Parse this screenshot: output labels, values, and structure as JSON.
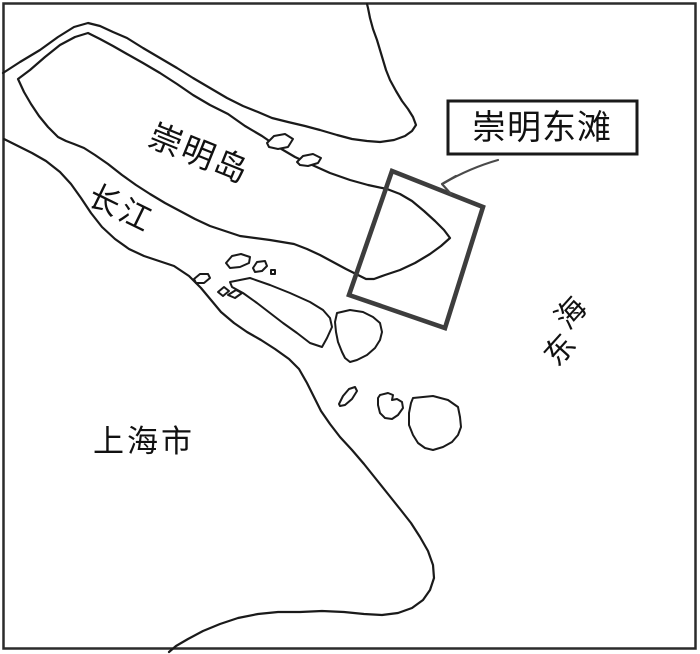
{
  "figure": {
    "background": "#ffffff",
    "border_color": "#2b2b2b",
    "line_color": "#1a1a1a",
    "highlight_color": "#3d3d3d",
    "arrow_color": "#4a4a4a",
    "text_color": "#111111"
  },
  "labels": {
    "chongming_island": "崇明岛",
    "yangtze_river": "长江",
    "shanghai_city": "上海市",
    "east_china_sea": "东海",
    "east_china_sea_char_1": "东",
    "east_china_sea_char_2": "海",
    "callout": "崇明东滩"
  }
}
